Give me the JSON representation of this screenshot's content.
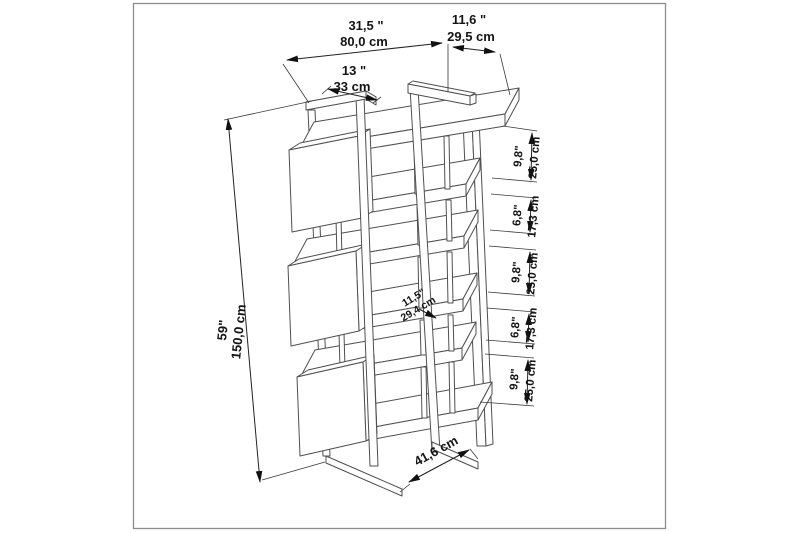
{
  "figure": {
    "type": "technical-dimension-drawing",
    "subject": "Etagere bookcase with staggered box shelves, isometric view with dimensions"
  },
  "colors": {
    "background": "#ffffff",
    "border": "#8d8d8d",
    "wireframe_line": "#4f4f4f",
    "dimension_line": "#222222",
    "text": "#141414"
  },
  "dimensions": {
    "width": {
      "inches": "31,5 \"",
      "cm": "80,0 cm"
    },
    "depth": {
      "inches": "11,6 \"",
      "cm": "29,5 cm"
    },
    "top_box_width": {
      "inches": "13 \"",
      "cm": "33 cm"
    },
    "height": {
      "inches": "59\"",
      "cm": "150,0 cm"
    },
    "shelf_depth": {
      "inches": "11,5\"",
      "cm": "29,4 cm"
    },
    "base_depth": {
      "cm": "41,6 cm"
    },
    "shelf_gaps": [
      {
        "inches": "9,8\"",
        "cm": "25,0 cm"
      },
      {
        "inches": "6,8\"",
        "cm": "17,3 cm"
      },
      {
        "inches": "9,8\"",
        "cm": "25,0 cm"
      },
      {
        "inches": "6,8\"",
        "cm": "17,3 cm"
      },
      {
        "inches": "9,8\"",
        "cm": "25,0 cm"
      }
    ]
  }
}
